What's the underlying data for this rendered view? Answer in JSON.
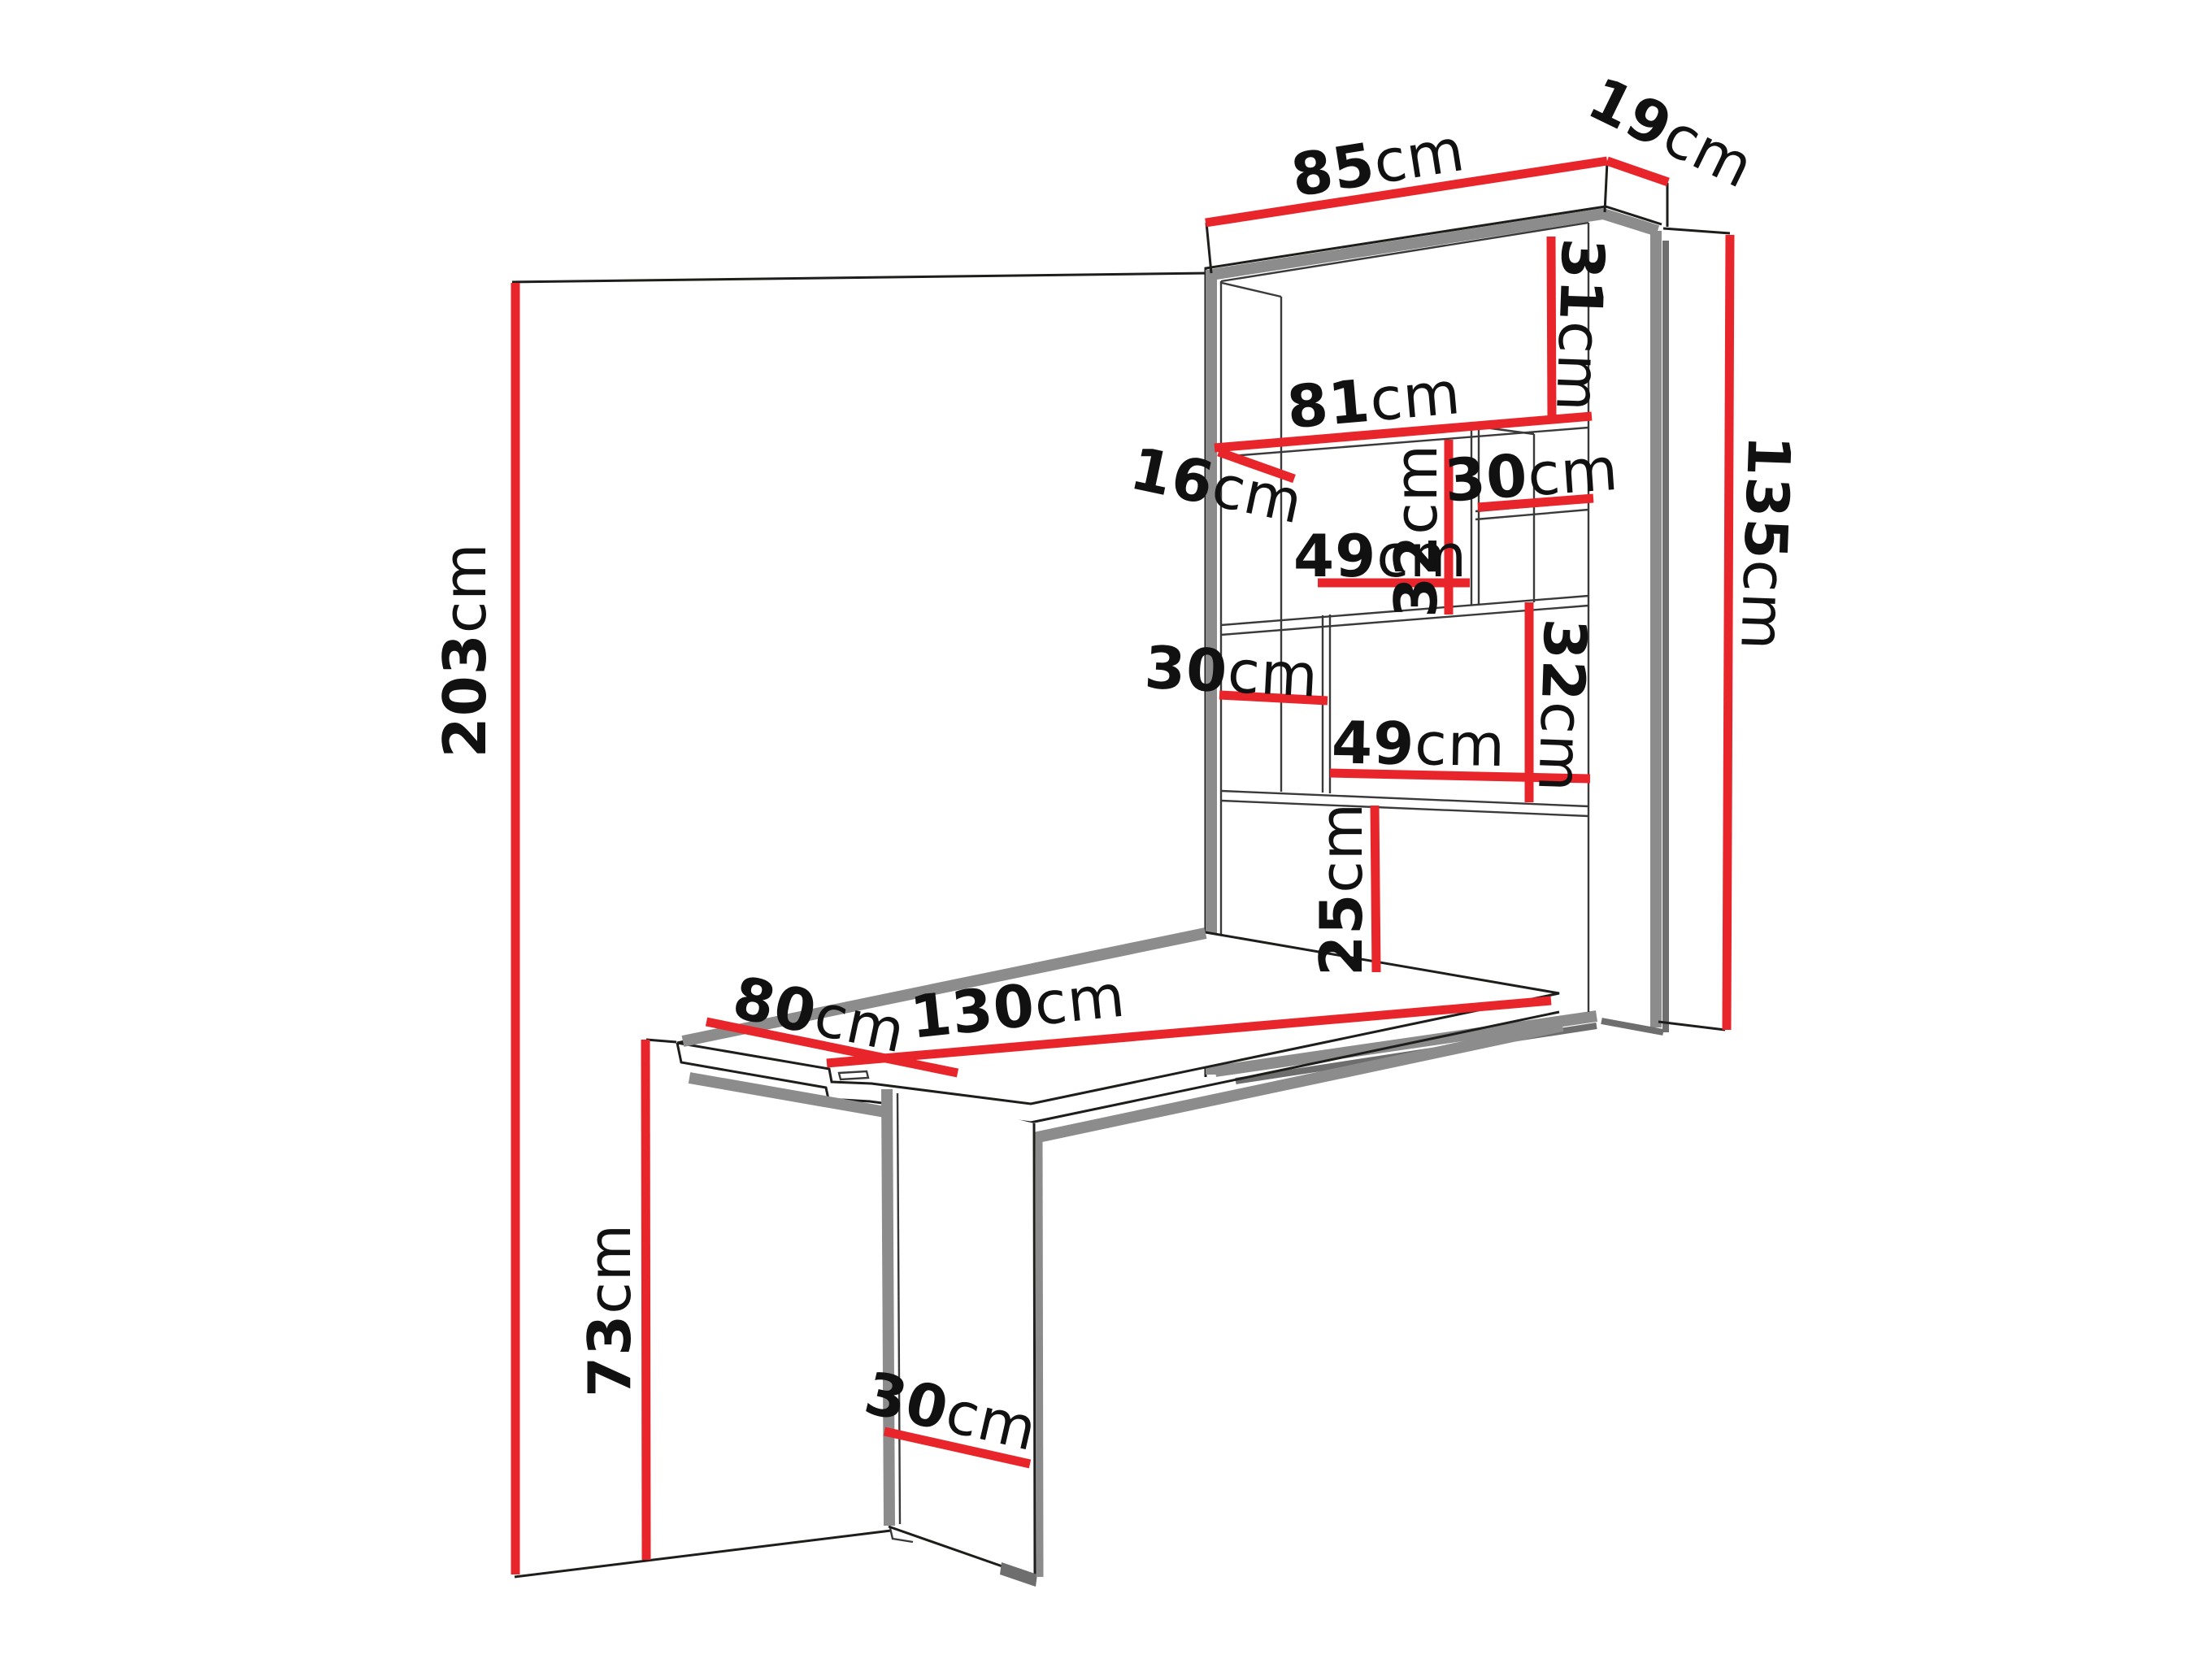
{
  "diagram_type": "furniture-dimension-diagram",
  "colors": {
    "dimension_red": "#e8252a",
    "line_black": "#1d1d1b",
    "edge_gray": "#8c8c8c",
    "shadow_gray": "#6e6e6e",
    "text_black": "#111111",
    "background": "#ffffff"
  },
  "dimensions": {
    "cabinet_width": {
      "value": "85",
      "unit": "cm"
    },
    "cabinet_depth": {
      "value": "19",
      "unit": "cm"
    },
    "top_compartment_height": {
      "value": "31",
      "unit": "cm"
    },
    "inner_width": {
      "value": "81",
      "unit": "cm"
    },
    "top_shelf_depth": {
      "value": "16",
      "unit": "cm"
    },
    "upper_right_compartment_width": {
      "value": "30",
      "unit": "cm"
    },
    "upper_left_compartment_width": {
      "value": "49",
      "unit": "cm"
    },
    "upper_compartment_height": {
      "value": "32",
      "unit": "cm"
    },
    "cabinet_height": {
      "value": "135",
      "unit": "cm"
    },
    "lower_left_compartment_width": {
      "value": "30",
      "unit": "cm"
    },
    "lower_right_compartment_width": {
      "value": "49",
      "unit": "cm"
    },
    "lower_compartment_height": {
      "value": "32",
      "unit": "cm"
    },
    "bottom_compartment_height": {
      "value": "25",
      "unit": "cm"
    },
    "wall_height": {
      "value": "203",
      "unit": "cm"
    },
    "table_width": {
      "value": "80",
      "unit": "cm"
    },
    "table_length": {
      "value": "130",
      "unit": "cm"
    },
    "table_height": {
      "value": "73",
      "unit": "cm"
    },
    "leg_width": {
      "value": "30",
      "unit": "cm"
    }
  }
}
